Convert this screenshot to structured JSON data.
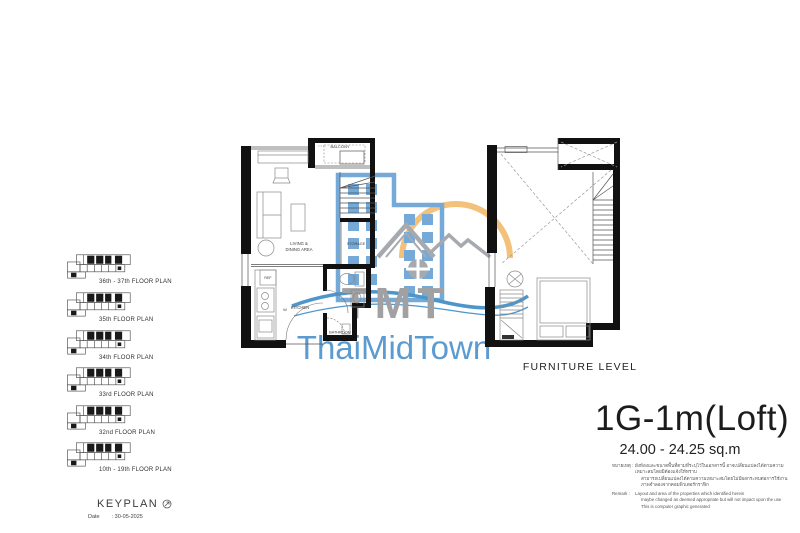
{
  "keyplan": {
    "title": "KEYPLAN",
    "date_label": "Date",
    "date_value": ": 30-05-2025",
    "items": [
      {
        "label": "36th - 37th FLOOR PLAN"
      },
      {
        "label": "35th FLOOR PLAN"
      },
      {
        "label": "34th FLOOR PLAN"
      },
      {
        "label": "33rd FLOOR PLAN"
      },
      {
        "label": "32nd FLOOR PLAN"
      },
      {
        "label": "10th - 19th FLOOR PLAN"
      }
    ]
  },
  "main_plan": {
    "labels": {
      "balcony": "BALCONY",
      "living_line1": "LIVING &",
      "living_line2": "DINING AREA",
      "storage": "STORAGE",
      "ref": "REF",
      "washer": "W",
      "kitchen": "KITCHEN",
      "bathroom": "BATHROOM"
    }
  },
  "furniture_plan": {
    "label": "FURNITURE LEVEL"
  },
  "watermark": {
    "acronym": "TMT",
    "name": "ThaiMidTown",
    "colors": {
      "building": "#74A9D8",
      "sun": "#F3C17A",
      "roof": "#A6AAAF",
      "wave": "#4D96CC",
      "acronym": "#A1A1A3",
      "name": "#5C9BD0"
    }
  },
  "unit": {
    "title": "1G-1m(Loft)",
    "area": "24.00 - 24.25 sq.m"
  },
  "remark": {
    "thai_label": "หมายเหตุ :",
    "thai_lines": [
      "ผังห้องและขนาดพื้นที่ตามที่ระบุไว้ในเอกสารนี้ อาจเปลี่ยนแปลงได้ตามความเหมาะสมโดยมิต้องแจ้งให้ทราบ",
      "สามารถเปลี่ยนแปลงได้ตามความเหมาะสมโดยไม่มีผลกระทบต่อการใช้งาน",
      "ภาพจำลองจากคอมพิวเตอร์กราฟิก"
    ],
    "en_label": "Remark :",
    "en_lines": [
      "Layout and area of the properties which identified herein",
      "maybe changed as deemed appropriate but will not impact upon the use",
      "This is computer graphic generated"
    ]
  }
}
